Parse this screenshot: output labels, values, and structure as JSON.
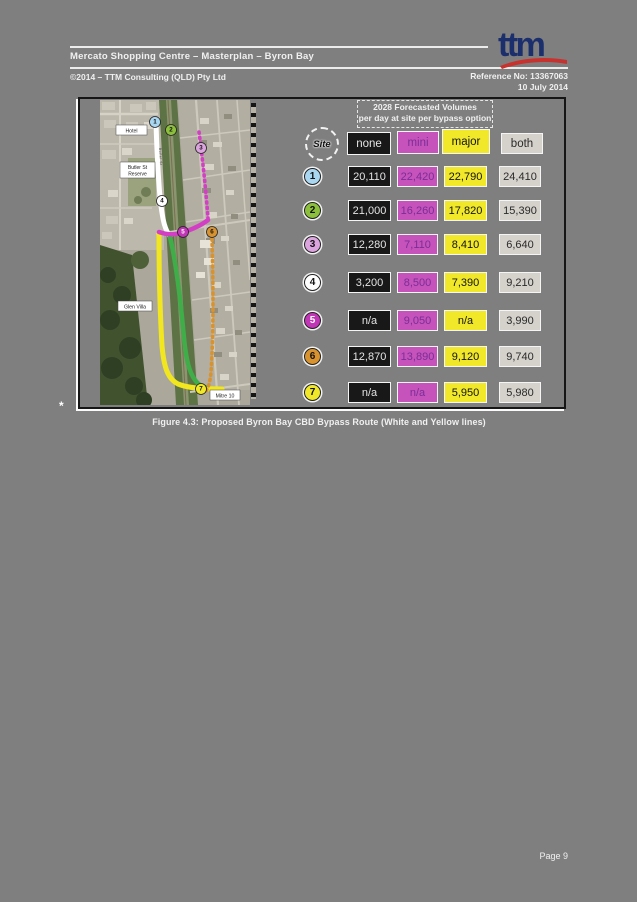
{
  "page": {
    "header": {
      "title": "Mercato Shopping Centre – Masterplan – Byron Bay",
      "copyright": "©2014 – TTM Consulting (QLD) Pty Ltd",
      "reference": "Reference No: 13367063",
      "date": "10 July 2014",
      "logo": "ttm"
    },
    "footer": {
      "page_number": "Page 9"
    },
    "stray_mark": "*"
  },
  "figure": {
    "caption": "Figure 4.3: Proposed Byron Bay CBD Bypass Route (White and Yellow lines)",
    "table": {
      "title_line1": "2028 Forecasted Volumes",
      "title_line2": "per day at site per bypass option",
      "site_header": "Site",
      "columns": [
        {
          "key": "none",
          "label": "none",
          "bg": "#181818",
          "fg": "#e4e4e4"
        },
        {
          "key": "mini",
          "label": "mini",
          "bg": "#c553bb",
          "fg": "#7c2d96"
        },
        {
          "key": "major",
          "label": "major",
          "bg": "#f0e829",
          "fg": "#141414"
        },
        {
          "key": "both",
          "label": "both",
          "bg": "#d5d1cb",
          "fg": "#2b2b2b"
        }
      ],
      "rows": [
        {
          "site": "1",
          "color": "#a9d7f1",
          "num_color": "#111111",
          "none": "20,110",
          "mini": "22,420",
          "major": "22,790",
          "both": "24,410"
        },
        {
          "site": "2",
          "color": "#8cc03c",
          "num_color": "#111111",
          "none": "21,000",
          "mini": "16,260",
          "major": "17,820",
          "both": "15,390"
        },
        {
          "site": "3",
          "color": "#dba4de",
          "num_color": "#111111",
          "none": "12,280",
          "mini": "7,110",
          "major": "8,410",
          "both": "6,640"
        },
        {
          "site": "4",
          "color": "#ffffff",
          "num_color": "#111111",
          "none": "3,200",
          "mini": "8,500",
          "major": "7,390",
          "both": "9,210"
        },
        {
          "site": "5",
          "color": "#c136b6",
          "num_color": "#ffffff",
          "none": "n/a",
          "mini": "9,050",
          "major": "n/a",
          "both": "3,990"
        },
        {
          "site": "6",
          "color": "#d8932f",
          "num_color": "#111111",
          "none": "12,870",
          "mini": "13,890",
          "major": "9,120",
          "both": "9,740"
        },
        {
          "site": "7",
          "color": "#f0e829",
          "num_color": "#111111",
          "none": "n/a",
          "mini": "n/a",
          "major": "5,950",
          "both": "5,980"
        }
      ]
    },
    "map": {
      "labels": {
        "hotel": "Hotel",
        "reserve_line1": "Butler St",
        "reserve_line2": "Reserve",
        "glen_villa": "Glen Villa",
        "mitre10": "Mitre 10",
        "street": "Butler St"
      },
      "route_colors": {
        "white_route": "#ffffff",
        "yellow_route": "#f2e71e",
        "green_route": "#3fae49",
        "magenta_route": "#d33fc4",
        "orange_route": "#d8932f"
      },
      "sites": [
        {
          "num": "1",
          "color": "#a9d7f1",
          "num_color": "#111111"
        },
        {
          "num": "2",
          "color": "#8cc03c",
          "num_color": "#111111"
        },
        {
          "num": "3",
          "color": "#dba4de",
          "num_color": "#111111"
        },
        {
          "num": "4",
          "color": "#ffffff",
          "num_color": "#111111"
        },
        {
          "num": "5",
          "color": "#c136b6",
          "num_color": "#ffffff"
        },
        {
          "num": "6",
          "color": "#d8932f",
          "num_color": "#111111"
        },
        {
          "num": "7",
          "color": "#f0e829",
          "num_color": "#111111"
        }
      ]
    }
  },
  "brand": {
    "logo_navy": "#1c2f6d",
    "logo_red": "#c8322e"
  }
}
